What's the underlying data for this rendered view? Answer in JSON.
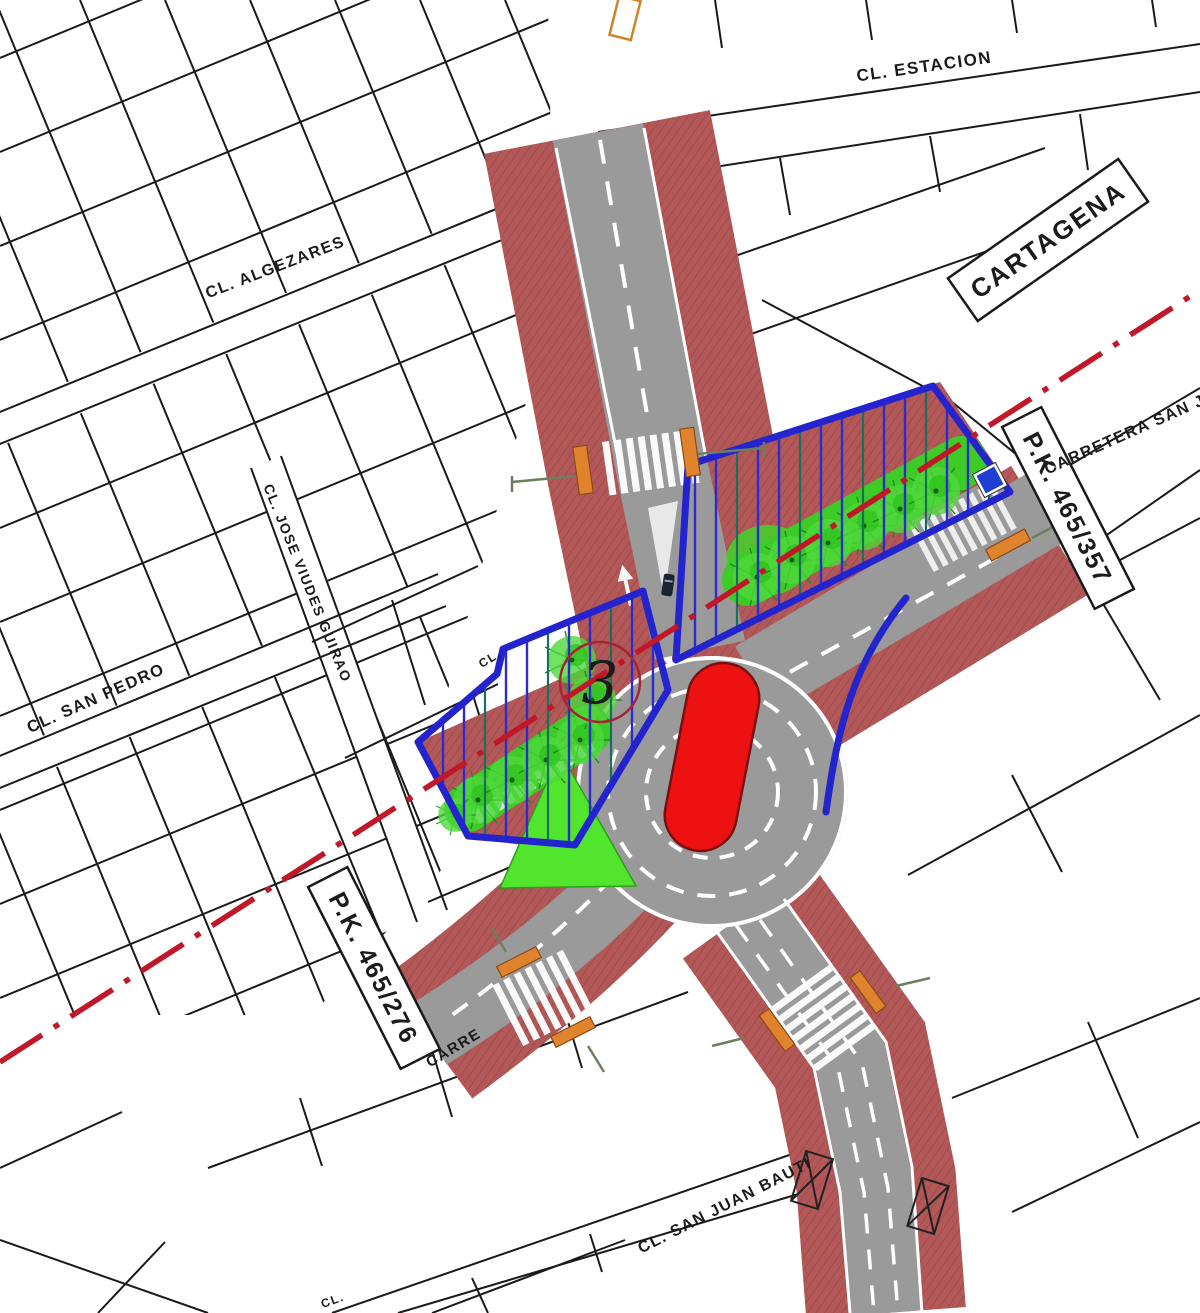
{
  "map": {
    "title": "Planta de ordenación - glorieta (plan view)",
    "streets": {
      "estacion": "CL. ESTACION",
      "algezares": "CL. ALGEZARES",
      "jose_viudes": "CL. JOSE VIUDES GUIRAO",
      "san_pedro": "CL. SAN PEDRO",
      "san_juan": "CL. SAN JUAN BAUTI",
      "carretera_san_javier": "CARRETERA SAN JAVIER",
      "carretera_partial": "CARRE",
      "cl_partial_mid": "CL.",
      "cl_partial_bottom": "CL."
    },
    "signs": {
      "cartagena": "CARTAGENA",
      "pk_right": "P.K. 465/357",
      "pk_left": "P.K. 465/276"
    },
    "markers": {
      "zone_number": "3"
    },
    "colors": {
      "sidewalk_red": "#b25757",
      "road_gray": "#9a9a9a",
      "green_area": "#3ecb28",
      "blue_zone": "#2424cf",
      "axis_red": "#c01828",
      "island_red": "#ee1111",
      "signal_orange": "#e0832f"
    }
  }
}
